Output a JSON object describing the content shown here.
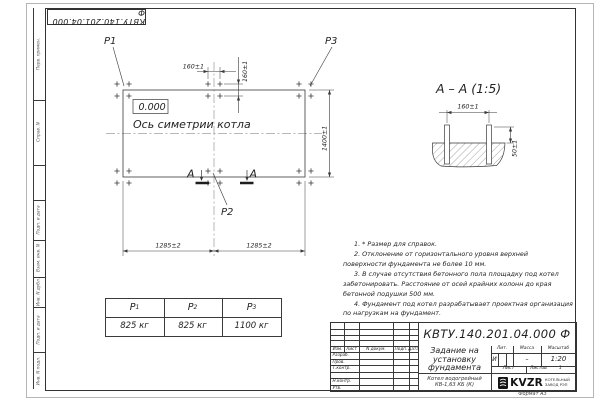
{
  "sheet": {
    "doc_number": "КВТУ.140.201.04.000 Ф",
    "format_note": "Формат А3"
  },
  "margin": {
    "labels": [
      "Перв. примен.",
      "Справ. N",
      "Подп. и дата",
      "Взам. инв. N",
      "Инв. N дубл.",
      "Подп. и дата",
      "Инв. N подл."
    ]
  },
  "plan": {
    "p1": "P1",
    "p2": "P2",
    "p3": "P3",
    "elevation": "0.000",
    "axis_caption": "Ось симетрии котла",
    "dim_bolt_h": "160±1",
    "dim_bolt_v": "160±1",
    "dim_height": "1400±1",
    "dim_left": "1285±2",
    "dim_right": "1285±2",
    "section_letter_left": "А",
    "section_letter_right": "А"
  },
  "section": {
    "title": "А – А (1:5)",
    "dim_width": "160±1",
    "dim_height": "50±1"
  },
  "notes": [
    "1. * Размер для справок.",
    "2. Отклонение от горизонтального уровня верхней поверхности фундамента не более 10 мм.",
    "3. В случае отсутствия бетонного пола площадку под котел забетонировать. Расстояние от осей крайних колонн до края бетонной подушки 500 мм.",
    "4. Фундамент под котел разрабатывает проектная организация по нагрузкам на фундамент."
  ],
  "load_table": {
    "columns": [
      {
        "name": "P",
        "sub": "1",
        "value": "825 кг"
      },
      {
        "name": "P",
        "sub": "2",
        "value": "825 кг"
      },
      {
        "name": "P",
        "sub": "3",
        "value": "1100 кг"
      }
    ]
  },
  "title_block": {
    "title_line1": "Задание на",
    "title_line2": "установку",
    "title_line3": "фундамента",
    "product_line1": "Котел водогрейный",
    "product_line2": "КВ-1,63 КБ (К)",
    "header": {
      "izm": "Изм.",
      "list": "Лист",
      "ndoc": "N докум.",
      "podp": "Подп.",
      "data": "Дата"
    },
    "roles": {
      "razrab": "Разраб.",
      "prov": "Пров.",
      "tkontr": "Т.контр.",
      "nkontr": "Н.контр.",
      "utv": "Утв."
    },
    "lit_h": "Лит.",
    "mass_h": "Масса",
    "scale_h": "Масштаб",
    "lit_v": "И",
    "mass_v": "–",
    "scale_v": "1:20",
    "sheet_h": "Лист",
    "sheets_h": "Листов",
    "sheets_v": "1",
    "brand": "KVZR",
    "brand_line1": "КОТЕЛЬНЫЙ",
    "brand_line2": "ЗАВОД РЭП"
  }
}
